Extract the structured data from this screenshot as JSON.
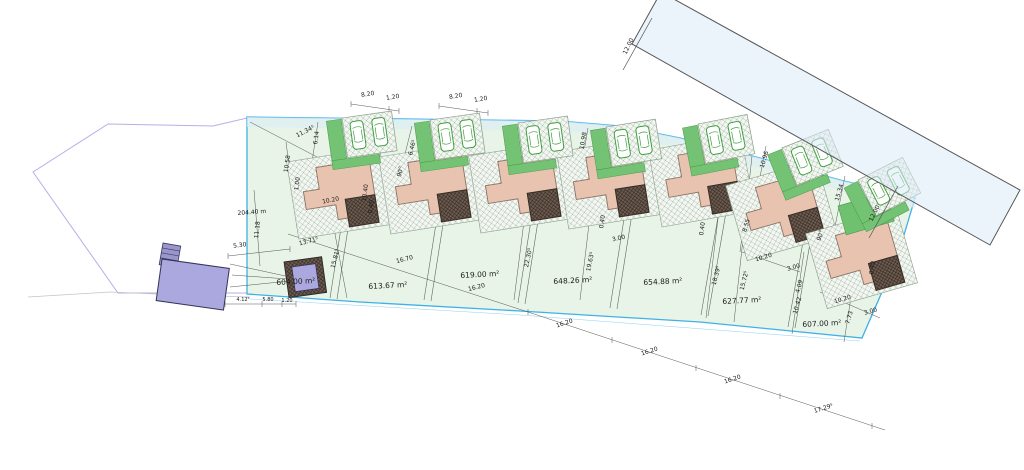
{
  "title": "Residential subdivision site plan",
  "colors": {
    "site_fill": "#e7f4e7",
    "site_border_cyan": "#3fb0e8",
    "lawn_green": "#74c374",
    "house_fill": "#e8c4b0",
    "garage_dark": "#6f5d52",
    "road_fill": "#dcebf8",
    "parcel_outline_purple": "#b9aee6",
    "building_purple": "#aaa8de",
    "line_dark": "#555555"
  },
  "plots": [
    {
      "number": 1,
      "area_label": "604.00 m²"
    },
    {
      "number": 2,
      "area_label": "613.67 m²"
    },
    {
      "number": 3,
      "area_label": "619.00 m²"
    },
    {
      "number": 4,
      "area_label": "648.26 m²"
    },
    {
      "number": 5,
      "area_label": "654.88 m²"
    },
    {
      "number": 6,
      "area_label": "627.77 m²"
    },
    {
      "number": 7,
      "area_label": "607.00 m²"
    }
  ],
  "labels": [
    {
      "text": "604.00 m²",
      "x": 296,
      "y": 284,
      "r": -3,
      "cls": "area"
    },
    {
      "text": "613.67 m²",
      "x": 388,
      "y": 288,
      "r": -3,
      "cls": "area"
    },
    {
      "text": "619.00 m²",
      "x": 480,
      "y": 277,
      "r": -3,
      "cls": "area"
    },
    {
      "text": "648.26 m²",
      "x": 573,
      "y": 283,
      "r": -3,
      "cls": "area"
    },
    {
      "text": "654.88 m²",
      "x": 663,
      "y": 284,
      "r": -3,
      "cls": "area"
    },
    {
      "text": "627.77 m²",
      "x": 742,
      "y": 303,
      "r": -3,
      "cls": "area"
    },
    {
      "text": "607.00 m²",
      "x": 822,
      "y": 326,
      "r": -3,
      "cls": "area"
    },
    {
      "text": "8.20",
      "x": 368,
      "y": 96,
      "r": -9,
      "cls": "dim"
    },
    {
      "text": "1.20",
      "x": 393,
      "y": 99,
      "r": -9,
      "cls": "dim"
    },
    {
      "text": "8.20",
      "x": 456,
      "y": 98,
      "r": -9,
      "cls": "dim"
    },
    {
      "text": "1.20",
      "x": 481,
      "y": 101,
      "r": -9,
      "cls": "dim"
    },
    {
      "text": "12.00",
      "x": 630,
      "y": 47,
      "r": -64,
      "cls": "dim"
    },
    {
      "text": "12.00",
      "x": 876,
      "y": 214,
      "r": -64,
      "cls": "dim"
    },
    {
      "text": "204.40 m",
      "x": 252,
      "y": 214,
      "r": -4,
      "cls": "dim"
    },
    {
      "text": "5.30",
      "x": 240,
      "y": 247,
      "r": -7,
      "cls": "dim"
    },
    {
      "text": "11.34⁵",
      "x": 306,
      "y": 133,
      "r": -27,
      "cls": "dim"
    },
    {
      "text": "10.58",
      "x": 289,
      "y": 164,
      "r": -82,
      "cls": "dim"
    },
    {
      "text": "1.00",
      "x": 299,
      "y": 184,
      "r": -82,
      "cls": "dim"
    },
    {
      "text": "6.14",
      "x": 318,
      "y": 138,
      "r": -82,
      "cls": "dim"
    },
    {
      "text": "11.18",
      "x": 259,
      "y": 230,
      "r": -84,
      "cls": "dim"
    },
    {
      "text": "13.71⁵",
      "x": 309,
      "y": 243,
      "r": -14,
      "cls": "dim"
    },
    {
      "text": "15.81⁵",
      "x": 337,
      "y": 259,
      "r": -76,
      "cls": "dim"
    },
    {
      "text": "10.20",
      "x": 331,
      "y": 202,
      "r": -11,
      "cls": "dim"
    },
    {
      "text": "10.40",
      "x": 367,
      "y": 193,
      "r": -82,
      "cls": "dim"
    },
    {
      "text": "0.40",
      "x": 373,
      "y": 207,
      "r": -82,
      "cls": "dim"
    },
    {
      "text": "6.46⁵",
      "x": 414,
      "y": 148,
      "r": -76,
      "cls": "dim"
    },
    {
      "text": "90°",
      "x": 402,
      "y": 172,
      "r": -76,
      "cls": "dim"
    },
    {
      "text": "16.70",
      "x": 405,
      "y": 261,
      "r": -14,
      "cls": "dim"
    },
    {
      "text": "22.30⁵",
      "x": 530,
      "y": 258,
      "r": -78,
      "cls": "dim"
    },
    {
      "text": "16.20",
      "x": 477,
      "y": 289,
      "r": -14,
      "cls": "dim"
    },
    {
      "text": "3.00",
      "x": 619,
      "y": 240,
      "r": -12,
      "cls": "dim"
    },
    {
      "text": "19.63⁵",
      "x": 592,
      "y": 262,
      "r": -78,
      "cls": "dim"
    },
    {
      "text": "10.98",
      "x": 585,
      "y": 141,
      "r": -80,
      "cls": "dim"
    },
    {
      "text": "0.40",
      "x": 604,
      "y": 222,
      "r": -82,
      "cls": "dim"
    },
    {
      "text": "10.96",
      "x": 766,
      "y": 160,
      "r": -74,
      "cls": "dim"
    },
    {
      "text": "15.34",
      "x": 841,
      "y": 193,
      "r": -74,
      "cls": "dim"
    },
    {
      "text": "90°",
      "x": 822,
      "y": 236,
      "r": -74,
      "cls": "dim"
    },
    {
      "text": "8.55",
      "x": 748,
      "y": 226,
      "r": -74,
      "cls": "dim"
    },
    {
      "text": "18.39⁵",
      "x": 718,
      "y": 276,
      "r": -76,
      "cls": "dim"
    },
    {
      "text": "15.72⁵",
      "x": 746,
      "y": 281,
      "r": -76,
      "cls": "dim"
    },
    {
      "text": "10.20",
      "x": 764,
      "y": 259,
      "r": -16,
      "cls": "dim"
    },
    {
      "text": "3.00",
      "x": 794,
      "y": 269,
      "r": -16,
      "cls": "dim"
    },
    {
      "text": "10.20",
      "x": 843,
      "y": 301,
      "r": -16,
      "cls": "dim"
    },
    {
      "text": "3.00",
      "x": 871,
      "y": 313,
      "r": -16,
      "cls": "dim"
    },
    {
      "text": "4.09",
      "x": 801,
      "y": 287,
      "r": -74,
      "cls": "dim"
    },
    {
      "text": "10.42",
      "x": 799,
      "y": 306,
      "r": -74,
      "cls": "dim"
    },
    {
      "text": "7.73",
      "x": 851,
      "y": 318,
      "r": -74,
      "cls": "dim"
    },
    {
      "text": "0.40",
      "x": 874,
      "y": 268,
      "r": -82,
      "cls": "dim"
    },
    {
      "text": "0.40",
      "x": 704,
      "y": 229,
      "r": -82,
      "cls": "dim"
    },
    {
      "text": "16.20",
      "x": 565,
      "y": 325,
      "r": -18,
      "cls": "dim"
    },
    {
      "text": "16.20",
      "x": 650,
      "y": 353,
      "r": -18,
      "cls": "dim"
    },
    {
      "text": "16.20",
      "x": 733,
      "y": 381,
      "r": -18,
      "cls": "dim"
    },
    {
      "text": "17.29⁵",
      "x": 824,
      "y": 410,
      "r": -18,
      "cls": "dim"
    },
    {
      "text": "4.12⁵",
      "x": 243,
      "y": 301,
      "r": 0,
      "cls": "small"
    },
    {
      "text": "5.80",
      "x": 268,
      "y": 301,
      "r": 0,
      "cls": "small"
    },
    {
      "text": "1.20",
      "x": 287,
      "y": 302,
      "r": 0,
      "cls": "small"
    }
  ]
}
